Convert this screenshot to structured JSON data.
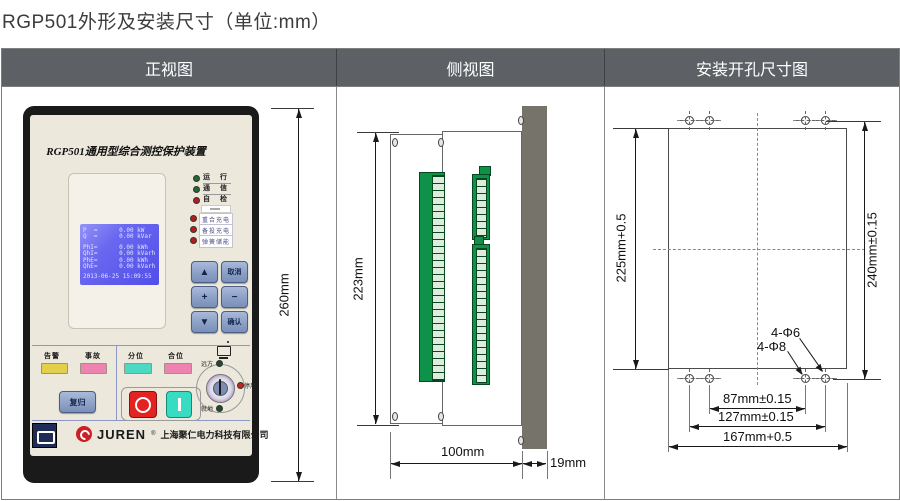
{
  "page": {
    "title": "RGP501外形及安装尺寸（单位:mm）"
  },
  "table": {
    "headers": [
      {
        "label": "正视图"
      },
      {
        "label": "侧视图"
      },
      {
        "label": "安装开孔尺寸图"
      }
    ]
  },
  "colors": {
    "header_bg": "#5d6166",
    "device_face": "#ece8dc",
    "lcd_blue": "#5a58ee",
    "terminal_green": "#0e9149",
    "panel_gray": "#76736b",
    "alarm_yellow": "#e2cf4b",
    "fault_pink": "#ee82b0",
    "open_cyan": "#4cd9c3",
    "close_pink": "#ee82b0",
    "trip_red": "#e32222",
    "close_teal": "#37dcc2"
  },
  "front_view": {
    "device_title": "RGP501通用型综合测控保护装置",
    "lcd": {
      "lines": [
        "P  =      0.00 kW",
        "Q  =      0.00 kVar",
        "PhI=      0.00 kWh",
        "QhI=      0.00 kVarh",
        "PhE=      0.00 kWh",
        "QhE=      0.00 kVarh"
      ],
      "timestamp": "2013-06-25 15:09:55"
    },
    "status_leds": [
      {
        "label": "运 行"
      },
      {
        "label": "通 信"
      },
      {
        "label": "自 检"
      }
    ],
    "charge_leds": [
      {
        "label": "重合充电"
      },
      {
        "label": "备投充电"
      },
      {
        "label": "弹簧储能"
      }
    ],
    "keys": {
      "up": "▲",
      "cancel": "取消",
      "plus": "+",
      "minus": "−",
      "down": "▼",
      "confirm": "确认"
    },
    "indicators": {
      "alarm": "告警",
      "fault": "事故",
      "open": "分位",
      "close": "合位"
    },
    "reset_label": "复归",
    "switch": {
      "remote": "远方",
      "local": "就地",
      "disabled": "停用"
    },
    "brand": {
      "name": "JUREN",
      "reg": "®",
      "company": "上海聚仁电力科技有限公司"
    },
    "dim_height": "260mm"
  },
  "side_view": {
    "dim_height": "223mm",
    "dim_depth": "100mm",
    "dim_panel": "19mm"
  },
  "install_view": {
    "dim_left": "225mm+0.5",
    "dim_right": "240mm±0.15",
    "hole_small": "4-Φ6",
    "hole_large": "4-Φ8",
    "dim_holes_inner": "87mm±0.15",
    "dim_holes_outer": "127mm±0.15",
    "dim_cutout_width": "167mm+0.5"
  }
}
